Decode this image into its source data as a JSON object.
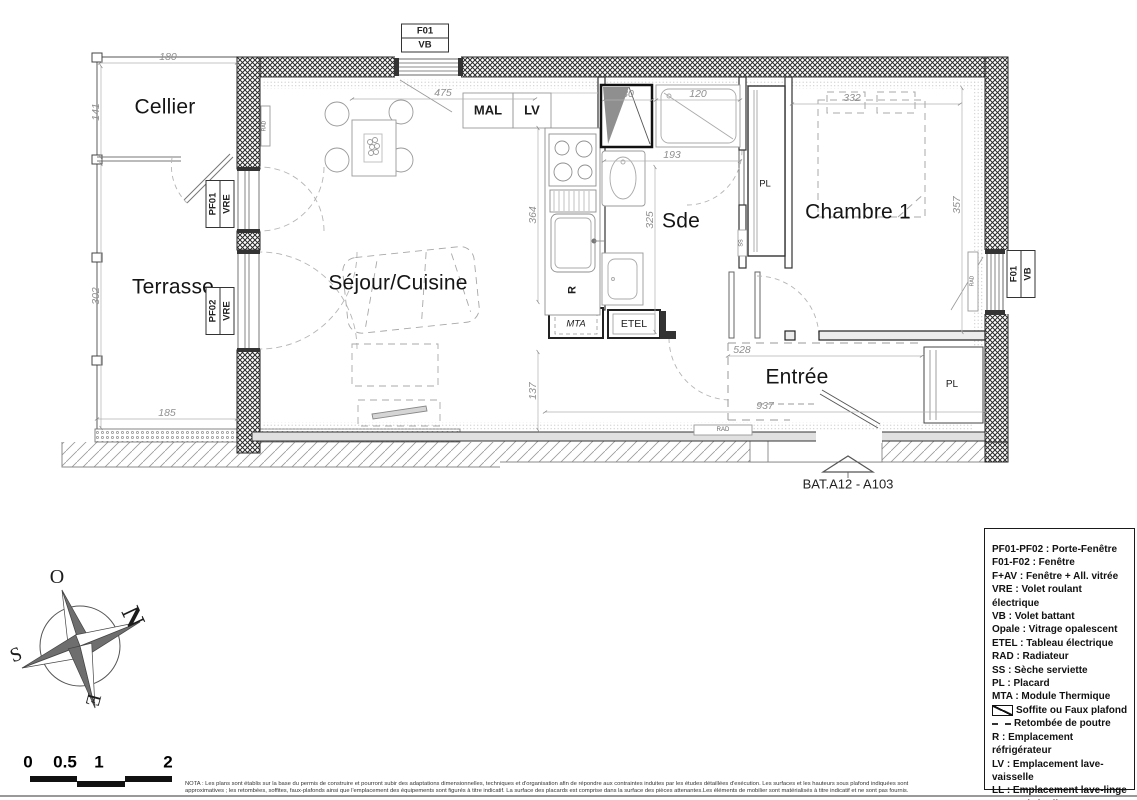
{
  "plan_texts": [
    {
      "t": "Cellier",
      "x": 165,
      "y": 107,
      "cls": "room",
      "name": "room-label-cellier"
    },
    {
      "t": "Terrasse",
      "x": 173,
      "y": 287,
      "cls": "room",
      "name": "room-label-terrasse"
    },
    {
      "t": "Séjour/Cuisine",
      "x": 398,
      "y": 283,
      "cls": "room",
      "name": "room-label-sejour-cuisine"
    },
    {
      "t": "Sde",
      "x": 681,
      "y": 221,
      "cls": "room",
      "name": "room-label-sde"
    },
    {
      "t": "Chambre 1",
      "x": 858,
      "y": 212,
      "cls": "room",
      "name": "room-label-chambre1"
    },
    {
      "t": "Entrée",
      "x": 797,
      "y": 377,
      "cls": "room",
      "name": "room-label-entree"
    },
    {
      "t": "MAL",
      "x": 488,
      "y": 110,
      "size": 13,
      "w": 700,
      "name": "label-mal"
    },
    {
      "t": "LV",
      "x": 532,
      "y": 110,
      "size": 13,
      "w": 700,
      "name": "label-lv"
    },
    {
      "t": "PL",
      "x": 765,
      "y": 184,
      "size": 9.5,
      "name": "label-pl-couloir"
    },
    {
      "t": "PL",
      "x": 952,
      "y": 385,
      "size": 10,
      "name": "label-pl-entree"
    },
    {
      "t": "R",
      "x": 573,
      "y": 290,
      "size": 11,
      "w": 700,
      "rot": -90,
      "name": "label-refrigerateur"
    },
    {
      "t": "MTA",
      "x": 576,
      "y": 324,
      "size": 9.5,
      "italic": true,
      "name": "label-mta"
    },
    {
      "t": "ETEL",
      "x": 634,
      "y": 324,
      "size": 10.5,
      "w": 500,
      "name": "label-etel"
    },
    {
      "t": "SS",
      "x": 742,
      "y": 243,
      "size": 5.5,
      "rot": -90,
      "col": "#555",
      "name": "label-ss"
    },
    {
      "t": "RAD",
      "x": 265,
      "y": 126,
      "size": 5,
      "rot": -90,
      "col": "#666",
      "name": "label-rad-sejour"
    },
    {
      "t": "RAD",
      "x": 723,
      "y": 430,
      "size": 6,
      "col": "#666",
      "name": "label-rad-bas"
    },
    {
      "t": "RAD",
      "x": 973,
      "y": 281,
      "size": 5,
      "rot": -90,
      "col": "#666",
      "name": "label-rad-chambre"
    },
    {
      "t": "BAT.A12 - A103",
      "x": 848,
      "y": 484,
      "size": 13,
      "col": "#222",
      "name": "plan-reference"
    },
    {
      "t": "180",
      "x": 168,
      "y": 57,
      "cls": "dim",
      "name": "dim-180"
    },
    {
      "t": "141",
      "x": 96,
      "y": 112,
      "cls": "dim",
      "rot": -90,
      "name": "dim-141"
    },
    {
      "t": "302",
      "x": 96,
      "y": 296,
      "cls": "dim",
      "rot": -90,
      "name": "dim-302"
    },
    {
      "t": "185",
      "x": 167,
      "y": 413,
      "cls": "dim",
      "name": "dim-185"
    },
    {
      "t": "475",
      "x": 443,
      "y": 93,
      "cls": "dim",
      "name": "dim-475"
    },
    {
      "t": "364",
      "x": 533,
      "y": 215,
      "cls": "dim",
      "rot": -90,
      "name": "dim-364"
    },
    {
      "t": "137",
      "x": 533,
      "y": 391,
      "cls": "dim",
      "rot": -90,
      "name": "dim-137"
    },
    {
      "t": "937",
      "x": 765,
      "y": 406,
      "cls": "dim",
      "name": "dim-937"
    },
    {
      "t": "80",
      "x": 628,
      "y": 94,
      "cls": "dim",
      "name": "dim-80"
    },
    {
      "t": "120",
      "x": 698,
      "y": 94,
      "cls": "dim",
      "name": "dim-120"
    },
    {
      "t": "193",
      "x": 672,
      "y": 155,
      "cls": "dim",
      "name": "dim-193"
    },
    {
      "t": "325",
      "x": 650,
      "y": 220,
      "cls": "dim",
      "rot": -90,
      "name": "dim-325"
    },
    {
      "t": "332",
      "x": 852,
      "y": 98,
      "cls": "dim",
      "name": "dim-332"
    },
    {
      "t": "357",
      "x": 957,
      "y": 205,
      "cls": "dim",
      "rot": -90,
      "name": "dim-357"
    },
    {
      "t": "528",
      "x": 742,
      "y": 350,
      "cls": "dim",
      "name": "dim-528"
    },
    {
      "t": "O",
      "x": 57,
      "y": 577,
      "size": 20,
      "serif": true,
      "name": "compass-west"
    },
    {
      "t": "N",
      "x": 133,
      "y": 617,
      "size": 27,
      "w": 600,
      "rot": 65,
      "serif": true,
      "name": "compass-north"
    },
    {
      "t": "S",
      "x": 16,
      "y": 655,
      "size": 20,
      "rot": -20,
      "serif": true,
      "name": "compass-south"
    },
    {
      "t": "E",
      "x": 93,
      "y": 700,
      "size": 20,
      "rot": 105,
      "serif": true,
      "name": "compass-east"
    },
    {
      "t": "0",
      "x": 28,
      "y": 762,
      "cls": "scale",
      "name": "scale-label-0"
    },
    {
      "t": "0.5",
      "x": 65,
      "y": 762,
      "cls": "scale",
      "name": "scale-label-05"
    },
    {
      "t": "1",
      "x": 99,
      "y": 762,
      "cls": "scale",
      "name": "scale-label-1"
    },
    {
      "t": "2",
      "x": 168,
      "y": 762,
      "cls": "scale",
      "name": "scale-label-2"
    }
  ],
  "window_tags": [
    {
      "lines": [
        "F01",
        "VB"
      ],
      "x": 425,
      "y": 38,
      "rot": 0
    },
    {
      "lines": [
        "F01",
        "VB"
      ],
      "x": 1021,
      "y": 274,
      "rot": -90
    },
    {
      "lines": [
        "PF01",
        "VRE"
      ],
      "x": 220,
      "y": 204,
      "rot": -90
    },
    {
      "lines": [
        "PF02",
        "VRE"
      ],
      "x": 220,
      "y": 311,
      "rot": -90
    }
  ],
  "legend": {
    "items": [
      {
        "text": "PF01-PF02 : Porte-Fenêtre"
      },
      {
        "text": "F01-F02 : Fenêtre"
      },
      {
        "text": "F+AV : Fenêtre + All. vitrée"
      },
      {
        "text": "VRE : Volet roulant électrique"
      },
      {
        "text": "VB : Volet battant"
      },
      {
        "text": "Opale : Vitrage opalescent"
      },
      {
        "text": "ETEL : Tableau électrique"
      },
      {
        "text": "RAD : Radiateur"
      },
      {
        "text": "SS : Sèche serviette"
      },
      {
        "text": "PL : Placard"
      },
      {
        "text": "MTA : Module Thermique"
      },
      {
        "icon": "soffite",
        "text": "Soffite ou Faux plafond"
      },
      {
        "icon": "beam",
        "text": "Retombée de poutre"
      },
      {
        "text": "R : Emplacement réfrigérateur"
      },
      {
        "text": "LV : Emplacement lave-vaisselle"
      },
      {
        "text": "LL : Emplacement lave-linge\n     ou sèche-linge"
      },
      {
        "icon": "cuisson",
        "text": "Emplacement cuisson"
      }
    ]
  },
  "nota": {
    "text": "NOTA : Les plans sont établis sur la base du permis de construire et pourront subir des adaptations dimensionnelles, techniques et d'organisation afin de répondre aux contraintes induites par les études détaillées d'exécution. Les surfaces et les hauteurs sous plafond indiquées sont approximatives ; les retombées, soffites, faux-plafonds ainsi que l'emplacement des équipements sont figurés à titre indicatif. La surface des placards est comprise dans la surface des pièces attenantes.Les éléments de mobilier sont matérialisés à titre indicatif et ne sont pas fournis."
  }
}
